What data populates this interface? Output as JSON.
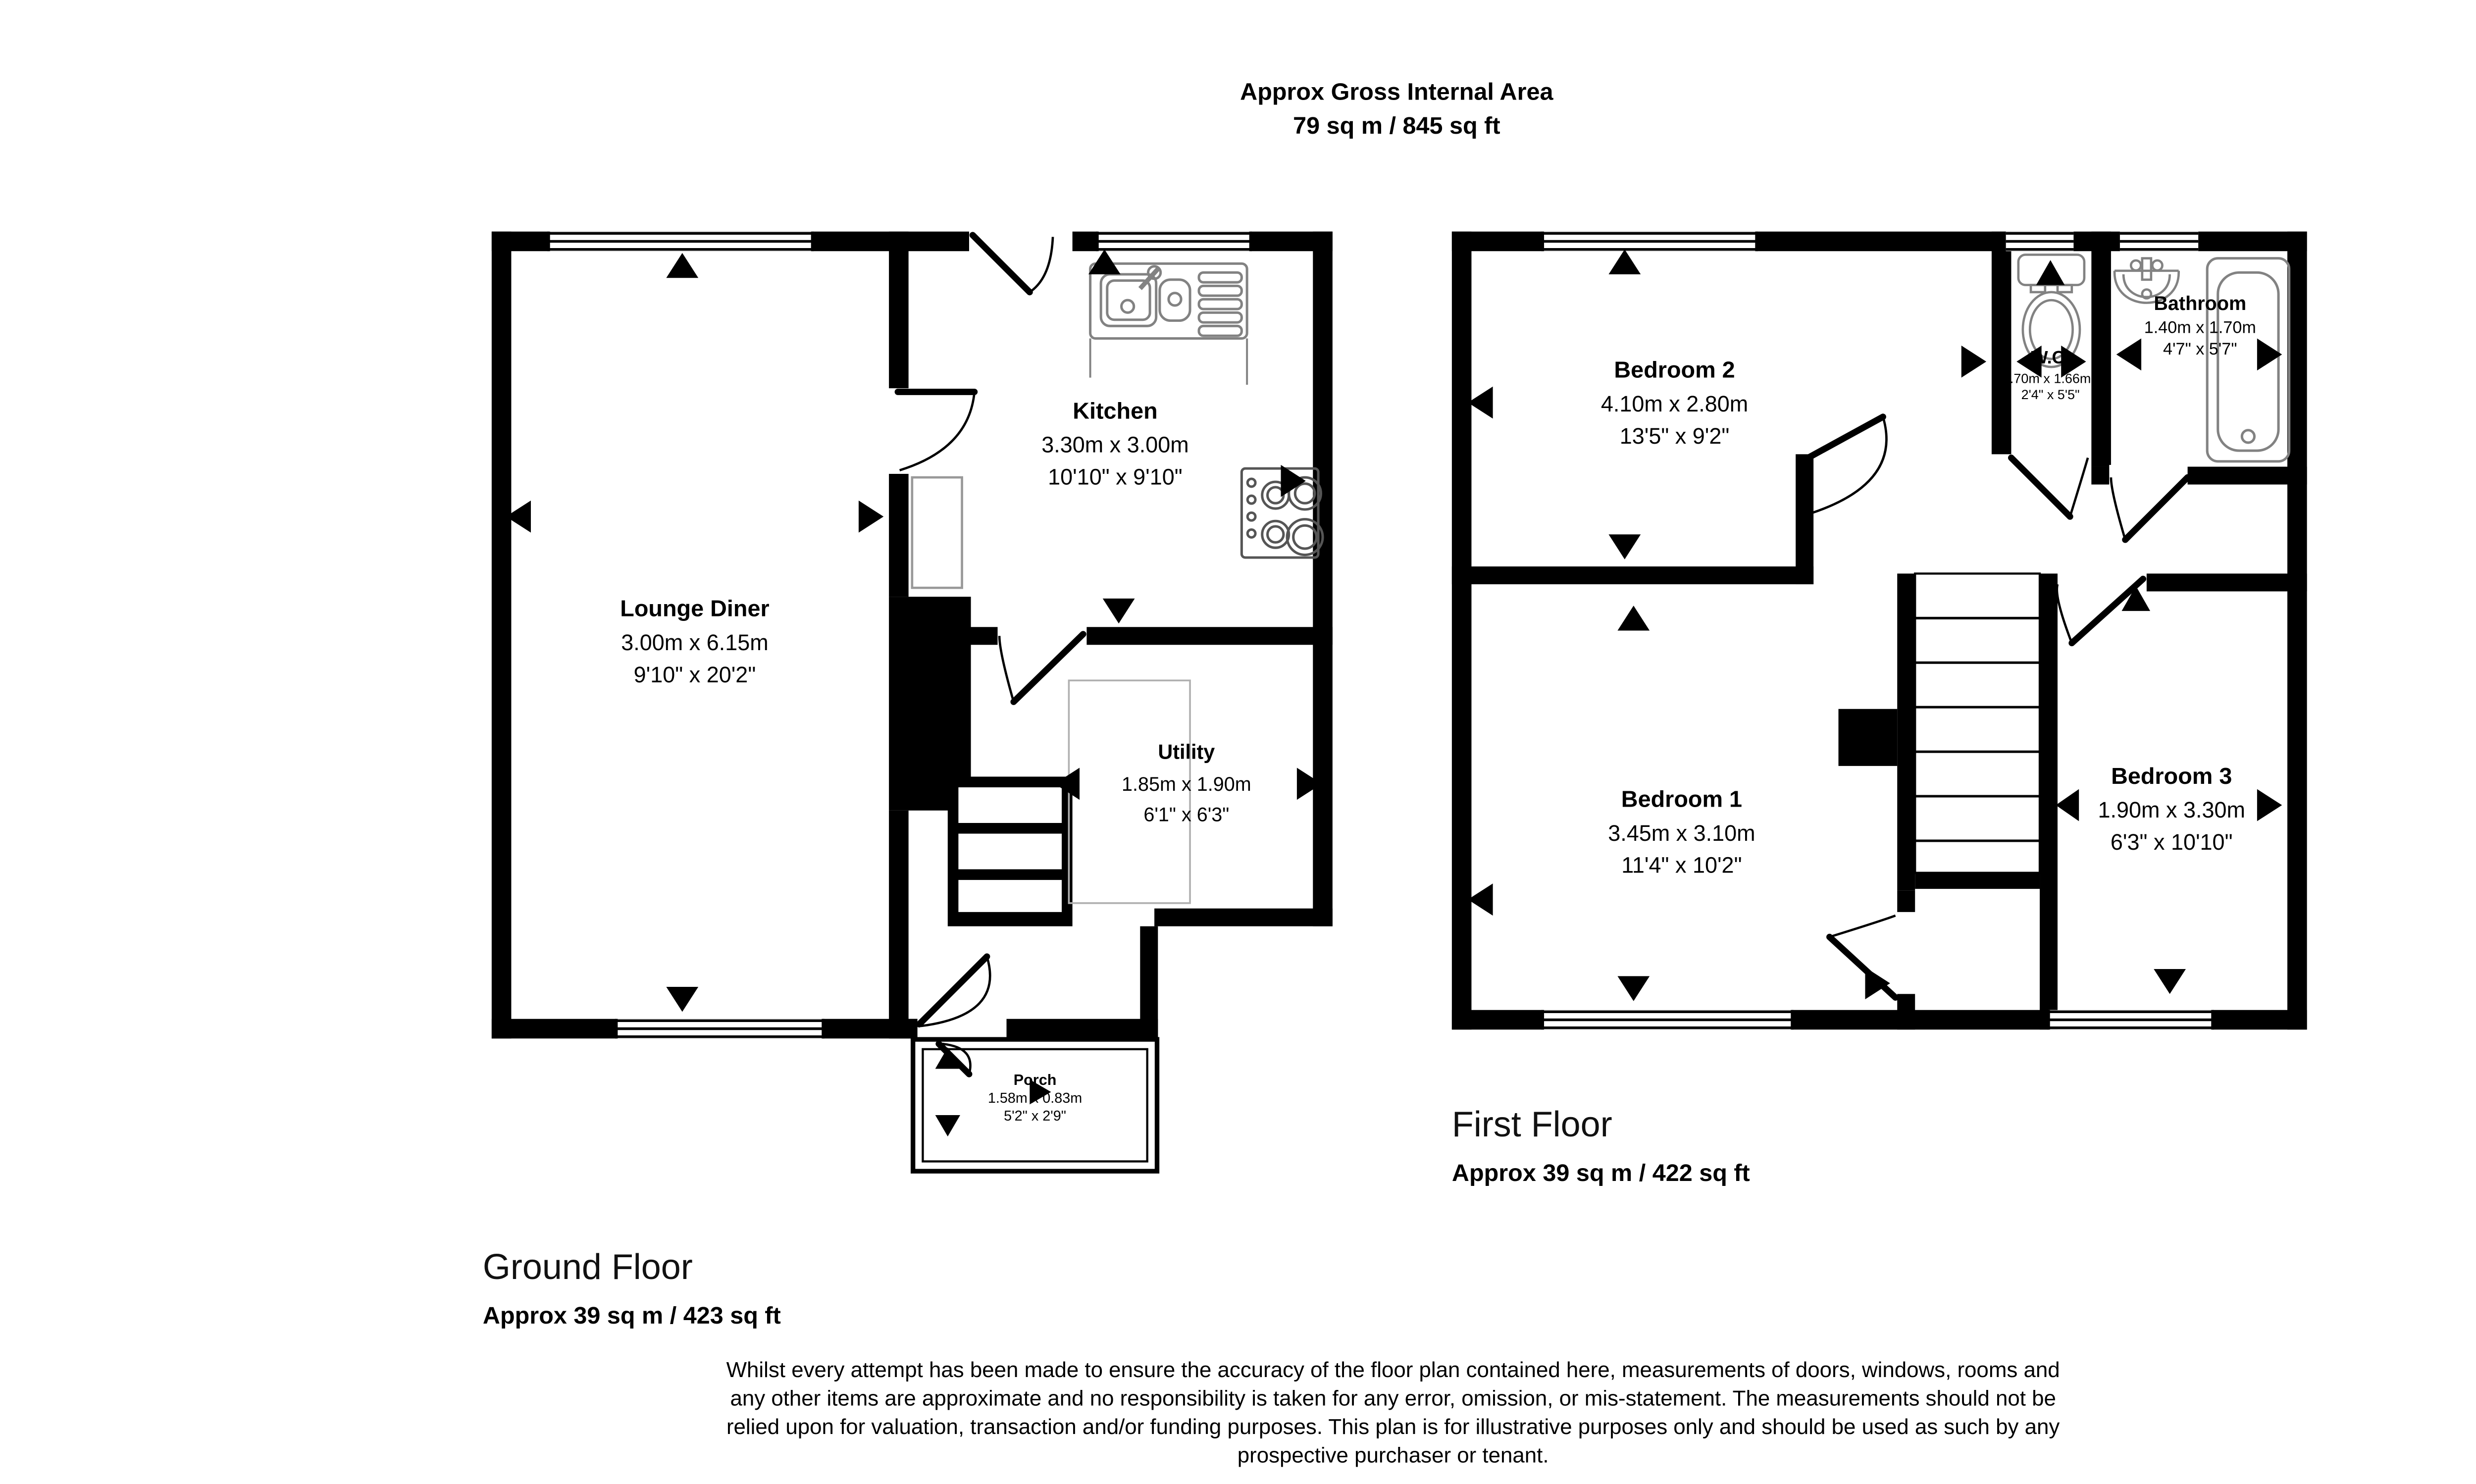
{
  "title": {
    "line1": "Approx Gross Internal Area",
    "line2": "79 sq m / 845 sq ft"
  },
  "ground_floor": {
    "name": "Ground Floor",
    "area": "Approx 39 sq m / 423 sq ft",
    "rooms": [
      {
        "name": "Lounge Diner",
        "metric": "3.00m x 6.15m",
        "imperial": "9'10\" x 20'2\""
      },
      {
        "name": "Kitchen",
        "metric": "3.30m x 3.00m",
        "imperial": "10'10\" x 9'10\""
      },
      {
        "name": "Utility",
        "metric": "1.85m x 1.90m",
        "imperial": "6'1\" x 6'3\""
      },
      {
        "name": "Porch",
        "metric": "1.58m x 0.83m",
        "imperial": "5'2\" x 2'9\""
      }
    ]
  },
  "first_floor": {
    "name": "First Floor",
    "area": "Approx 39 sq m / 422 sq ft",
    "rooms": [
      {
        "name": "Bedroom 2",
        "metric": "4.10m x 2.80m",
        "imperial": "13'5\" x 9'2\""
      },
      {
        "name": "W.C.",
        "metric": ".70m x 1.66m",
        "imperial": "2'4\" x 5'5\""
      },
      {
        "name": "Bathroom",
        "metric": "1.40m x 1.70m",
        "imperial": "4'7\" x 5'7\""
      },
      {
        "name": "Bedroom 1",
        "metric": "3.45m x 3.10m",
        "imperial": "11'4\" x 10'2\""
      },
      {
        "name": "Bedroom 3",
        "metric": "1.90m x 3.30m",
        "imperial": "6'3\" x 10'10\""
      }
    ]
  },
  "disclaimer": {
    "lines": [
      "Whilst every attempt has been made to ensure the accuracy of the floor plan contained here, measurements of doors, windows, rooms and",
      "any other items are approximate and no responsibility is taken for any error, omission, or mis-statement. The measurements should not be",
      "relied upon for valuation, transaction and/or funding purposes. This plan is for illustrative purposes only and should be used as such by any",
      "prospective purchaser or tenant."
    ]
  },
  "colors": {
    "wall": "#000000",
    "fixture": "#828282",
    "background": "#ffffff"
  }
}
